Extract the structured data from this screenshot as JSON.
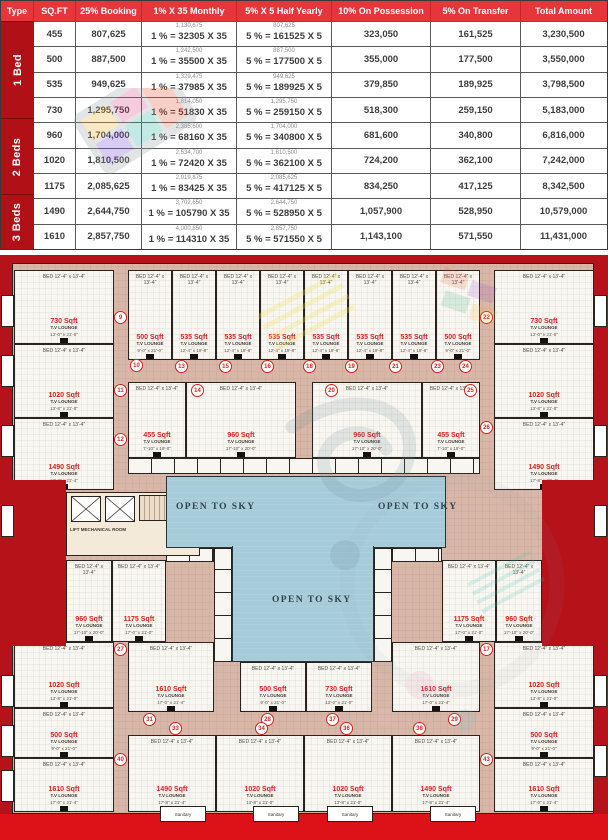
{
  "payment_table": {
    "headers": [
      "Type",
      "SQ.FT",
      "25% Booking",
      "1% X 35 Monthly",
      "5% X 5 Half Yearly",
      "10% On Possession",
      "5% On Transfer",
      "Total Amount"
    ],
    "groups": [
      {
        "label": "1 Bed",
        "rows": 4
      },
      {
        "label": "2 Beds",
        "rows": 3
      },
      {
        "label": "3 Beds",
        "rows": 2
      }
    ],
    "rows": [
      {
        "sqft": "455",
        "booking": "807,625",
        "monthly_small": "1,130,675",
        "monthly": "1 % = 32305 X 35",
        "half_small": "807,625",
        "half": "5 % = 161525 X 5",
        "possession": "323,050",
        "transfer": "161,525",
        "total": "3,230,500"
      },
      {
        "sqft": "500",
        "booking": "887,500",
        "monthly_small": "1,242,500",
        "monthly": "1 % = 35500 X 35",
        "half_small": "887,500",
        "half": "5 % = 177500 X 5",
        "possession": "355,000",
        "transfer": "177,500",
        "total": "3,550,000"
      },
      {
        "sqft": "535",
        "booking": "949,625",
        "monthly_small": "1,329,475",
        "monthly": "1 % = 37985 X 35",
        "half_small": "949,625",
        "half": "5 % = 189925 X 5",
        "possession": "379,850",
        "transfer": "189,925",
        "total": "3,798,500"
      },
      {
        "sqft": "730",
        "booking": "1,295,750",
        "monthly_small": "1,814,050",
        "monthly": "1 % = 51830 X 35",
        "half_small": "1,295,750",
        "half": "5 % = 259150 X 5",
        "possession": "518,300",
        "transfer": "259,150",
        "total": "5,183,000"
      },
      {
        "sqft": "960",
        "booking": "1,704,000",
        "monthly_small": "2,385,600",
        "monthly": "1 % = 68160 X 35",
        "half_small": "1,704,000",
        "half": "5 % = 340800 X 5",
        "possession": "681,600",
        "transfer": "340,800",
        "total": "6,816,000"
      },
      {
        "sqft": "1020",
        "booking": "1,810,500",
        "monthly_small": "2,534,700",
        "monthly": "1 % = 72420 X 35",
        "half_small": "1,810,500",
        "half": "5 % = 362100 X 5",
        "possession": "724,200",
        "transfer": "362,100",
        "total": "7,242,000"
      },
      {
        "sqft": "1175",
        "booking": "2,085,625",
        "monthly_small": "2,919,875",
        "monthly": "1 % = 83425 X 35",
        "half_small": "2,085,625",
        "half": "5 % = 417125 X 5",
        "possession": "834,250",
        "transfer": "417,125",
        "total": "8,342,500"
      },
      {
        "sqft": "1490",
        "booking": "2,644,750",
        "monthly_small": "3,702,650",
        "monthly": "1 % = 105790 X 35",
        "half_small": "2,644,750",
        "half": "5 % = 528950 X 5",
        "possession": "1,057,900",
        "transfer": "528,950",
        "total": "10,579,000"
      },
      {
        "sqft": "1610",
        "booking": "2,857,750",
        "monthly_small": "4,000,850",
        "monthly": "1 % = 114310 X 35",
        "half_small": "2,857,750",
        "half": "5 % = 571550 X 5",
        "possession": "1,143,100",
        "transfer": "571,550",
        "total": "11,431,000"
      }
    ]
  },
  "floorplan": {
    "open_to_sky": "OPEN TO SKY",
    "lift_room": "LIFT MECHANICAL ROOM",
    "sanitary": "Sanitary",
    "tv_lounge": "T.V LOUNGE",
    "bed_label": "BED",
    "bed_dim": "12'-4\" x 13'-4\"",
    "units": [
      {
        "label": "730 Sqft",
        "dim": "13'-0\" x 21'-0\"",
        "x": 14,
        "y": 15,
        "w": 100,
        "h": 74
      },
      {
        "label": "1020 Sqft",
        "dim": "13'-8\" x 21'-0\"",
        "x": 14,
        "y": 89,
        "w": 100,
        "h": 74
      },
      {
        "label": "1490 Sqft",
        "dim": "17'-8\" x 21'-4\"",
        "x": 14,
        "y": 163,
        "w": 100,
        "h": 72
      },
      {
        "label": "730 Sqft",
        "dim": "13'-0\" x 21'-0\"",
        "x": 494,
        "y": 15,
        "w": 100,
        "h": 74
      },
      {
        "label": "1020 Sqft",
        "dim": "13'-8\" x 21'-0\"",
        "x": 494,
        "y": 89,
        "w": 100,
        "h": 74
      },
      {
        "label": "1490 Sqft",
        "dim": "17'-8\" x 21'-4\"",
        "x": 494,
        "y": 163,
        "w": 100,
        "h": 72
      },
      {
        "label": "500 Sqft",
        "dim": "9'-0\" x 21'-0\"",
        "x": 128,
        "y": 15,
        "w": 44,
        "h": 90
      },
      {
        "label": "535 Sqft",
        "dim": "12'-4\" x 19'-8\"",
        "x": 172,
        "y": 15,
        "w": 44,
        "h": 90
      },
      {
        "label": "535 Sqft",
        "dim": "12'-4\" x 19'-8\"",
        "x": 216,
        "y": 15,
        "w": 44,
        "h": 90
      },
      {
        "label": "535 Sqft",
        "dim": "12'-4\" x 19'-8\"",
        "x": 260,
        "y": 15,
        "w": 44,
        "h": 90
      },
      {
        "label": "535 Sqft",
        "dim": "12'-4\" x 19'-8\"",
        "x": 304,
        "y": 15,
        "w": 44,
        "h": 90
      },
      {
        "label": "535 Sqft",
        "dim": "12'-4\" x 19'-8\"",
        "x": 348,
        "y": 15,
        "w": 44,
        "h": 90
      },
      {
        "label": "535 Sqft",
        "dim": "12'-4\" x 19'-8\"",
        "x": 392,
        "y": 15,
        "w": 44,
        "h": 90
      },
      {
        "label": "500 Sqft",
        "dim": "9'-0\" x 21'-0\"",
        "x": 436,
        "y": 15,
        "w": 44,
        "h": 90
      },
      {
        "label": "455 Sqft",
        "dim": "7'-10\" x 19'-0\"",
        "x": 128,
        "y": 127,
        "w": 58,
        "h": 76
      },
      {
        "label": "960 Sqft",
        "dim": "17'-10\" x 20'-0\"",
        "x": 186,
        "y": 127,
        "w": 110,
        "h": 76
      },
      {
        "label": "960 Sqft",
        "dim": "17'-10\" x 20'-0\"",
        "x": 312,
        "y": 127,
        "w": 110,
        "h": 76
      },
      {
        "label": "455 Sqft",
        "dim": "7'-10\" x 19'-0\"",
        "x": 422,
        "y": 127,
        "w": 58,
        "h": 76
      },
      {
        "label": "960 Sqft",
        "dim": "17'-10\" x 20'-0\"",
        "x": 66,
        "y": 305,
        "w": 46,
        "h": 82
      },
      {
        "label": "1175 Sqft",
        "dim": "17'-0\" x 21'-0\"",
        "x": 112,
        "y": 305,
        "w": 54,
        "h": 82
      },
      {
        "label": "1175 Sqft",
        "dim": "17'-0\" x 21'-0\"",
        "x": 442,
        "y": 305,
        "w": 54,
        "h": 82
      },
      {
        "label": "960 Sqft",
        "dim": "17'-10\" x 20'-0\"",
        "x": 496,
        "y": 305,
        "w": 46,
        "h": 82
      },
      {
        "label": "1020 Sqft",
        "dim": "13'-8\" x 21'-0\"",
        "x": 14,
        "y": 387,
        "w": 100,
        "h": 66
      },
      {
        "label": "500 Sqft",
        "dim": "9'-0\" x 21'-0\"",
        "x": 14,
        "y": 453,
        "w": 100,
        "h": 50
      },
      {
        "label": "1610 Sqft",
        "dim": "17'-0\" x 21'-4\"",
        "x": 14,
        "y": 503,
        "w": 100,
        "h": 54
      },
      {
        "label": "1020 Sqft",
        "dim": "13'-8\" x 21'-0\"",
        "x": 494,
        "y": 387,
        "w": 100,
        "h": 66
      },
      {
        "label": "500 Sqft",
        "dim": "9'-0\" x 21'-0\"",
        "x": 494,
        "y": 453,
        "w": 100,
        "h": 50
      },
      {
        "label": "1610 Sqft",
        "dim": "17'-0\" x 21'-4\"",
        "x": 494,
        "y": 503,
        "w": 100,
        "h": 54
      },
      {
        "label": "1610 Sqft",
        "dim": "17'-0\" x 21'-4\"",
        "x": 128,
        "y": 387,
        "w": 86,
        "h": 70
      },
      {
        "label": "500 Sqft",
        "dim": "9'-0\" x 21'-0\"",
        "x": 240,
        "y": 407,
        "w": 66,
        "h": 50
      },
      {
        "label": "730 Sqft",
        "dim": "13'-0\" x 21'-0\"",
        "x": 306,
        "y": 407,
        "w": 66,
        "h": 50
      },
      {
        "label": "1610 Sqft",
        "dim": "17'-0\" x 21'-4\"",
        "x": 392,
        "y": 387,
        "w": 88,
        "h": 70
      },
      {
        "label": "1490 Sqft",
        "dim": "17'-8\" x 21'-4\"",
        "x": 128,
        "y": 480,
        "w": 88,
        "h": 77
      },
      {
        "label": "1020 Sqft",
        "dim": "13'-8\" x 21'-0\"",
        "x": 216,
        "y": 480,
        "w": 88,
        "h": 77
      },
      {
        "label": "1020 Sqft",
        "dim": "13'-8\" x 21'-0\"",
        "x": 304,
        "y": 480,
        "w": 88,
        "h": 77
      },
      {
        "label": "1490 Sqft",
        "dim": "17'-8\" x 21'-4\"",
        "x": 392,
        "y": 480,
        "w": 88,
        "h": 77
      }
    ],
    "circles": [
      {
        "n": "9",
        "x": 121,
        "y": 63
      },
      {
        "n": "22",
        "x": 487,
        "y": 63
      },
      {
        "n": "10",
        "x": 137,
        "y": 111
      },
      {
        "n": "13",
        "x": 182,
        "y": 112
      },
      {
        "n": "15",
        "x": 226,
        "y": 112
      },
      {
        "n": "16",
        "x": 268,
        "y": 112
      },
      {
        "n": "18",
        "x": 310,
        "y": 112
      },
      {
        "n": "19",
        "x": 352,
        "y": 112
      },
      {
        "n": "21",
        "x": 396,
        "y": 112
      },
      {
        "n": "23",
        "x": 438,
        "y": 112
      },
      {
        "n": "24",
        "x": 466,
        "y": 112
      },
      {
        "n": "11",
        "x": 121,
        "y": 136
      },
      {
        "n": "14",
        "x": 198,
        "y": 136
      },
      {
        "n": "20",
        "x": 332,
        "y": 136
      },
      {
        "n": "25",
        "x": 471,
        "y": 136
      },
      {
        "n": "12",
        "x": 121,
        "y": 185
      },
      {
        "n": "26",
        "x": 487,
        "y": 173
      },
      {
        "n": "27",
        "x": 121,
        "y": 395
      },
      {
        "n": "17",
        "x": 487,
        "y": 395
      },
      {
        "n": "31",
        "x": 150,
        "y": 465
      },
      {
        "n": "28",
        "x": 268,
        "y": 465
      },
      {
        "n": "37",
        "x": 333,
        "y": 465
      },
      {
        "n": "29",
        "x": 455,
        "y": 465
      },
      {
        "n": "33",
        "x": 176,
        "y": 474
      },
      {
        "n": "34",
        "x": 262,
        "y": 474
      },
      {
        "n": "36",
        "x": 347,
        "y": 474
      },
      {
        "n": "38",
        "x": 420,
        "y": 474
      },
      {
        "n": "40",
        "x": 121,
        "y": 505
      },
      {
        "n": "43",
        "x": 487,
        "y": 505
      }
    ],
    "tabs": [
      {
        "x": 1,
        "y": 40,
        "w": 13,
        "h": 32
      },
      {
        "x": 1,
        "y": 100,
        "w": 13,
        "h": 32
      },
      {
        "x": 1,
        "y": 170,
        "w": 13,
        "h": 32
      },
      {
        "x": 1,
        "y": 250,
        "w": 13,
        "h": 32
      },
      {
        "x": 1,
        "y": 420,
        "w": 13,
        "h": 32
      },
      {
        "x": 1,
        "y": 470,
        "w": 13,
        "h": 32
      },
      {
        "x": 1,
        "y": 515,
        "w": 13,
        "h": 32
      },
      {
        "x": 594,
        "y": 40,
        "w": 13,
        "h": 32
      },
      {
        "x": 594,
        "y": 170,
        "w": 13,
        "h": 32
      },
      {
        "x": 594,
        "y": 250,
        "w": 13,
        "h": 32
      },
      {
        "x": 594,
        "y": 420,
        "w": 13,
        "h": 32
      },
      {
        "x": 594,
        "y": 490,
        "w": 13,
        "h": 32
      },
      {
        "x": 160,
        "y": 551,
        "w": 46,
        "h": 16,
        "label": "Sanitary"
      },
      {
        "x": 253,
        "y": 551,
        "w": 46,
        "h": 16,
        "label": "Sanitary"
      },
      {
        "x": 327,
        "y": 551,
        "w": 46,
        "h": 16,
        "label": "Sanitary"
      },
      {
        "x": 430,
        "y": 551,
        "w": 46,
        "h": 16,
        "label": "Sanitary"
      }
    ]
  }
}
